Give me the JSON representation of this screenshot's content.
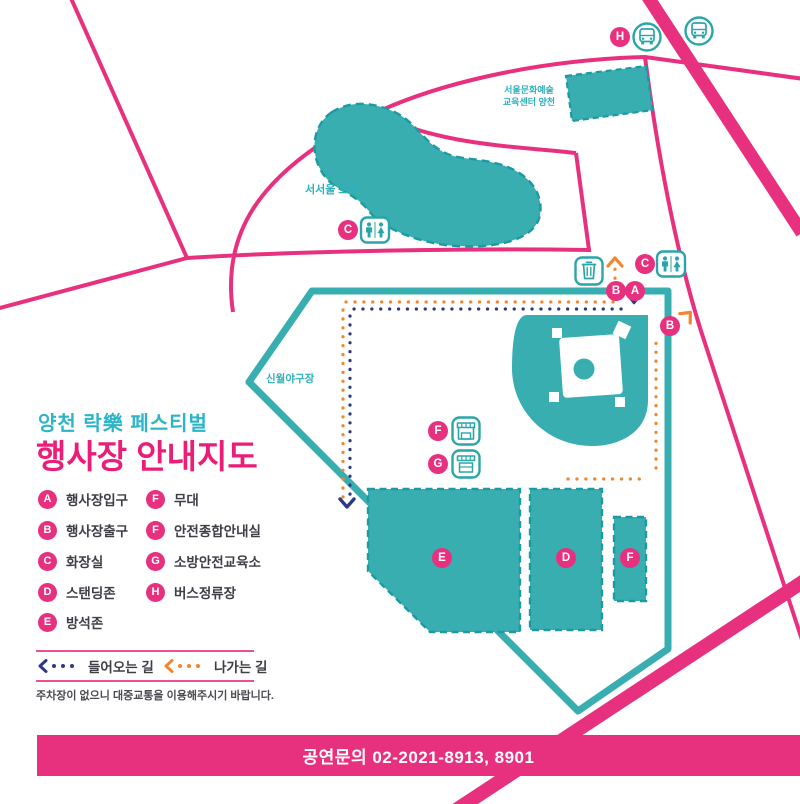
{
  "header": {
    "subtitle": "양천 락樂 페스티벌",
    "title": "행사장 안내지도"
  },
  "legend": {
    "items": [
      {
        "letter": "A",
        "label": "행사장입구"
      },
      {
        "letter": "B",
        "label": "행사장출구"
      },
      {
        "letter": "C",
        "label": "화장실"
      },
      {
        "letter": "D",
        "label": "스탠딩존"
      },
      {
        "letter": "E",
        "label": "방석존"
      },
      {
        "letter": "F",
        "label": "무대"
      },
      {
        "letter": "F",
        "label": "안전종합안내실"
      },
      {
        "letter": "G",
        "label": "소방안전교육소"
      },
      {
        "letter": "H",
        "label": "버스정류장"
      }
    ],
    "incoming_label": "들어오는 길",
    "outgoing_label": "나가는 길",
    "note": "주차장이 없으니 대중교통을 이용해주시기 바랍니다."
  },
  "map": {
    "labels": {
      "lake": "서서울 호수",
      "building_line1": "서울문화예술",
      "building_line2": "교육센터 양천",
      "field": "신월야구장"
    },
    "markers": [
      {
        "letter": "H"
      },
      {
        "letter": "C"
      },
      {
        "letter": "C"
      },
      {
        "letter": "B"
      },
      {
        "letter": "A"
      },
      {
        "letter": "B"
      },
      {
        "letter": "F"
      },
      {
        "letter": "G"
      },
      {
        "letter": "E"
      },
      {
        "letter": "D"
      },
      {
        "letter": "F"
      }
    ]
  },
  "footer": {
    "contact": "공연문의  02-2021-8913, 8901"
  },
  "colors": {
    "pink": "#e7317f",
    "teal": "#38aeb1",
    "teal_dark": "#1c9aa4",
    "navy": "#2c3a85",
    "orange": "#f1862e"
  }
}
